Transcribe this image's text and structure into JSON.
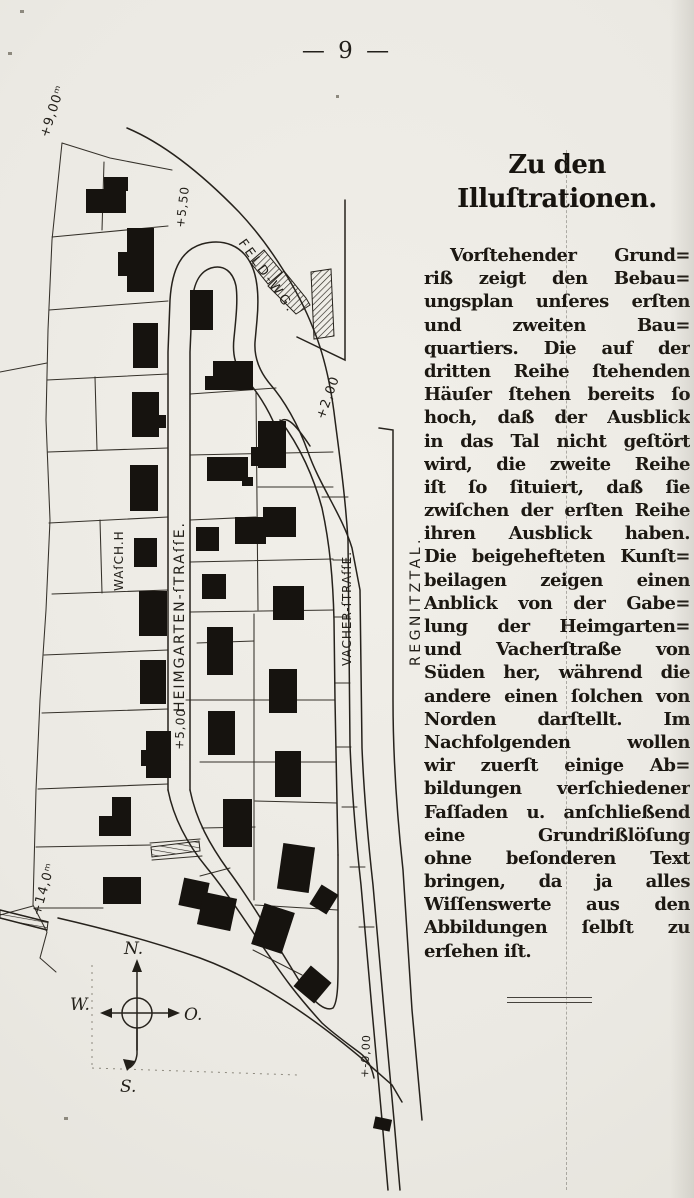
{
  "page": {
    "number_display": "— 9 —",
    "background": "#ebe9e3",
    "ink": "#1b1814"
  },
  "article": {
    "heading_lines": [
      "Zu den",
      "Illuſtrationen."
    ],
    "body_lines": [
      "Vorſtehender Grund=",
      "riß zeigt den Bebau=",
      "ungsplan unſeres erſten",
      "und zweiten Bau=",
      "quartiers. Die auf der",
      "dritten Reihe ſtehenden",
      "Häuſer ſtehen bereits ſo",
      "hoch, daß der Ausblick",
      "in das Tal nicht geſtört",
      "wird, die zweite Reihe",
      "iſt ſo ſituiert, daß ſie",
      "zwiſchen der erſten Reihe",
      "ihren Ausblick haben.",
      "Die beigehefteten Kunſt=",
      "beilagen zeigen einen",
      "Anblick von der Gabe=",
      "lung der Heimgarten=",
      "und Vacherſtraße von",
      "Süden her, während die",
      "andere einen ſolchen von",
      "Norden darſtellt. Im",
      "Nachfolgenden wollen",
      "wir zuerſt einige Ab=",
      "bildungen verſchiedener",
      "Faſſaden u. anſchließend",
      "eine Grundrißlöſung",
      "ohne beſonderen Text",
      "bringen, da ja alles",
      "Wiſſenswerte aus den",
      "Abbildungen ſelbſt zu",
      "erſehen iſt."
    ]
  },
  "map": {
    "ink": "#26221c",
    "streets": [
      "M 127,128 C 165,144 204,176 239,212 C 271,246 299,292 313,328 C 323,352 330,382 334,412 C 339,452 345,492 348,540 L 350,745 C 352,795 356,840 361,885 L 372,1010 L 382,1120 L 388,1190",
      "M 168,790 L 168,352 L 170,300 C 172,268 182,250 202,244 C 224,238 242,246 251,264 C 258,278 259,298 257,320 L 255,342 C 254,358 260,372 270,384 C 284,400 298,424 308,452 C 320,486 342,515 352,548 L 360,590 L 362,748 C 364,795 368,840 373,885 L 384,1010 L 394,1120 L 400,1190",
      "M 190,790 L 190,352 L 192,305 C 193,284 199,272 211,268 C 224,264 233,272 236,286 C 238,300 236,318 234,338 C 232,356 236,368 245,378 C 256,390 268,408 276,428 C 284,408 298,428 310,446",
      "M 190,790 C 196,820 210,845 228,870 C 252,902 280,950 305,990 C 315,1002 325,1012 333,1008 C 339,1000 338,975 338,940 L 338,855",
      "M 168,790 C 174,820 188,845 207,868 C 232,898 262,948 290,985 C 300,998 312,1012 322,1023 C 334,1034 348,1044 360,1053 C 368,1059 372,1068 374,1078",
      "M 58,918 C 110,930 160,944 200,958 C 230,969 258,984 283,1000 C 310,1017 340,1040 366,1062 L 392,1085 L 402,1102",
      "M 345,200 L 345,360 L 297,337",
      "M 379,428 L 393,430 L 393,700 C 393,760 397,815 403,870 L 412,1010 L 422,1120",
      "M 280,420 C 300,446 314,478 322,508 C 330,545 333,580 334,620 L 335,700 C 336,755 337,800 338,855",
      "M 0,910 L 48,922",
      "M 0,918 L 47,930"
    ],
    "parcels": [
      "M 62,143 L 52,240 L 48,330 L 46,420 L 50,520 L 46,610 L 40,700 L 36,790 L 33,905 L 47,932 L 40,958 L 56,972",
      "M 62,143 L 110,158 L 172,170",
      "M 0,372 L 47,363",
      "M 0,915 L 33,906",
      "M 52,237 L 168,226",
      "M 49,310 L 168,301",
      "M 47,380 L 168,374",
      "M 48,452 L 168,448",
      "M 49,523 L 168,517",
      "M 52,594 L 168,590",
      "M 44,655 L 168,650",
      "M 42,713 L 168,709",
      "M 38,789 L 168,784",
      "M 36,847 L 151,845",
      "M 34,908 L 103,908",
      "M 104,162 L 102,230",
      "M 95,377 L 97,450",
      "M 100,520 L 102,593",
      "M 190,394 L 276,388",
      "M 190,455 L 333,452",
      "M 258,487 L 333,487",
      "M 190,520 L 256,517",
      "M 190,562 L 333,559",
      "M 190,612 L 334,610",
      "M 197,643 L 254,641",
      "M 186,700 L 335,700",
      "M 200,762 L 336,762",
      "M 255,801 L 337,803",
      "M 202,828 L 255,827",
      "M 255,905 L 338,910",
      "M 253,950 L 302,975",
      "M 200,876 L 230,868",
      "M 256,392 L 258,610",
      "M 254,614 L 254,900",
      "M 322,497 L 348,497",
      "M 333,560 L 350,560",
      "M 334,617 L 350,617",
      "M 335,683 L 350,683",
      "M 336,747 L 351,747",
      "M 342,807 L 357,807",
      "M 350,867 L 365,867",
      "M 359,927 L 374,927",
      "M 150,843 L 200,839",
      "M 152,860 L 202,856"
    ],
    "buildings": [
      {
        "x": 86,
        "y": 189,
        "w": 40,
        "h": 24
      },
      {
        "x": 104,
        "y": 177,
        "w": 24,
        "h": 14
      },
      {
        "x": 127,
        "y": 228,
        "w": 27,
        "h": 64
      },
      {
        "x": 118,
        "y": 252,
        "w": 10,
        "h": 24
      },
      {
        "x": 133,
        "y": 323,
        "w": 25,
        "h": 45
      },
      {
        "x": 132,
        "y": 392,
        "w": 27,
        "h": 45
      },
      {
        "x": 159,
        "y": 415,
        "w": 7,
        "h": 13
      },
      {
        "x": 130,
        "y": 465,
        "w": 28,
        "h": 46
      },
      {
        "x": 134,
        "y": 538,
        "w": 23,
        "h": 29
      },
      {
        "x": 139,
        "y": 591,
        "w": 28,
        "h": 45
      },
      {
        "x": 140,
        "y": 660,
        "w": 26,
        "h": 44
      },
      {
        "x": 146,
        "y": 731,
        "w": 25,
        "h": 47
      },
      {
        "x": 141,
        "y": 750,
        "w": 6,
        "h": 16
      },
      {
        "x": 112,
        "y": 797,
        "w": 19,
        "h": 39
      },
      {
        "x": 99,
        "y": 816,
        "w": 14,
        "h": 20
      },
      {
        "x": 103,
        "y": 877,
        "w": 38,
        "h": 27
      },
      {
        "x": 181,
        "y": 880,
        "w": 26,
        "h": 28,
        "r": 12
      },
      {
        "x": 200,
        "y": 895,
        "w": 34,
        "h": 33,
        "r": 12
      },
      {
        "x": 190,
        "y": 290,
        "w": 23,
        "h": 40
      },
      {
        "x": 213,
        "y": 361,
        "w": 40,
        "h": 29
      },
      {
        "x": 205,
        "y": 376,
        "w": 9,
        "h": 14
      },
      {
        "x": 207,
        "y": 457,
        "w": 41,
        "h": 24
      },
      {
        "x": 242,
        "y": 477,
        "w": 11,
        "h": 9
      },
      {
        "x": 196,
        "y": 527,
        "w": 23,
        "h": 24
      },
      {
        "x": 202,
        "y": 574,
        "w": 24,
        "h": 25
      },
      {
        "x": 207,
        "y": 627,
        "w": 26,
        "h": 48
      },
      {
        "x": 208,
        "y": 711,
        "w": 27,
        "h": 44
      },
      {
        "x": 223,
        "y": 799,
        "w": 29,
        "h": 48
      },
      {
        "x": 258,
        "y": 421,
        "w": 28,
        "h": 47
      },
      {
        "x": 251,
        "y": 447,
        "w": 8,
        "h": 19
      },
      {
        "x": 235,
        "y": 517,
        "w": 31,
        "h": 27
      },
      {
        "x": 263,
        "y": 507,
        "w": 33,
        "h": 30
      },
      {
        "x": 273,
        "y": 586,
        "w": 31,
        "h": 34
      },
      {
        "x": 269,
        "y": 669,
        "w": 28,
        "h": 44
      },
      {
        "x": 275,
        "y": 751,
        "w": 26,
        "h": 46
      },
      {
        "x": 280,
        "y": 845,
        "w": 32,
        "h": 46,
        "r": 8
      },
      {
        "x": 314,
        "y": 888,
        "w": 20,
        "h": 23,
        "r": 32
      },
      {
        "x": 257,
        "y": 907,
        "w": 32,
        "h": 43,
        "r": 18
      },
      {
        "x": 299,
        "y": 971,
        "w": 27,
        "h": 27,
        "r": 40
      },
      {
        "x": 374,
        "y": 1118,
        "w": 17,
        "h": 12,
        "r": 12
      }
    ],
    "hatched": [
      {
        "points": "250,262 264,250 282,272 268,284",
        "fill": "hatch"
      },
      {
        "points": "268,286 284,271 306,298 310,305 296,314 278,296",
        "fill": "hatch"
      },
      {
        "points": "311,272 331,269 334,336 314,339",
        "fill": "hatch"
      },
      {
        "points": "151,847 199,841 200,851 152,857",
        "fill": "ties"
      },
      {
        "points": "0,910 48,922 47,930 0,918",
        "fill": "ties"
      }
    ],
    "dotted": [
      "M 92,965 L 92,1068",
      "M 92,1068 L 298,1075"
    ],
    "labels": [
      {
        "n": "elevation-plus-9-00",
        "t": "+9,00ᵐ",
        "x": 48,
        "y": 138,
        "r": -72,
        "s": 13,
        "ls": 1
      },
      {
        "n": "elevation-plus-5-50",
        "t": "+5,50",
        "x": 184,
        "y": 228,
        "r": -83,
        "s": 12,
        "ls": 1
      },
      {
        "n": "street-label-feld-weg",
        "t": "FELD-WG.",
        "x": 238,
        "y": 243,
        "r": 54,
        "s": 13,
        "ls": 3
      },
      {
        "n": "elevation-plus-2-00",
        "t": "+2,00",
        "x": 324,
        "y": 420,
        "r": -70,
        "s": 13,
        "ls": 1
      },
      {
        "n": "building-label-waschhaus",
        "t": "WAſCH.H",
        "x": 123,
        "y": 591,
        "r": -90,
        "s": 12,
        "ls": 1
      },
      {
        "n": "street-label-heimgartenstrasse",
        "t": "HEIMGARTEN-ſTRAſſE.",
        "x": 184,
        "y": 712,
        "r": -90,
        "s": 14,
        "ls": 2
      },
      {
        "n": "elevation-plus-5-00",
        "t": "+5,00",
        "x": 183,
        "y": 750,
        "r": -87,
        "s": 12,
        "ls": 1
      },
      {
        "n": "street-label-vacherstrasse",
        "t": "VACHER-ſTRAſſE.",
        "x": 351,
        "y": 666,
        "r": -90,
        "s": 12,
        "ls": 1
      },
      {
        "n": "area-label-regnitztal",
        "t": "REGNITZTAL.",
        "x": 420,
        "y": 666,
        "r": -90,
        "s": 14,
        "ls": 3.5
      },
      {
        "n": "elevation-zero",
        "t": "+-0,00",
        "x": 368,
        "y": 1078,
        "r": -87,
        "s": 11,
        "ls": 1
      },
      {
        "n": "elevation-plus-14-0",
        "t": "+14,0ᵐ",
        "x": 40,
        "y": 916,
        "r": -74,
        "s": 13,
        "ls": 1
      }
    ],
    "compass": {
      "circle": {
        "cx": 137,
        "cy": 1013,
        "r": 15
      },
      "shafts": [
        "M 137,1050 L 137,966",
        "M 103,1013 L 176,1013",
        "M 137,1028 L 137,1054 Q 136,1064 129,1068"
      ],
      "heads": [
        "137,959 132,972 142,972",
        "100,1013 112,1008 112,1018",
        "180,1013 168,1008 168,1018",
        "127,1071 123,1059 135,1061"
      ],
      "labels": [
        {
          "t": "N.",
          "x": 124,
          "y": 954
        },
        {
          "t": "O.",
          "x": 184,
          "y": 1020
        },
        {
          "t": "W.",
          "x": 70,
          "y": 1010
        },
        {
          "t": "S.",
          "x": 120,
          "y": 1092
        }
      ]
    },
    "specks": [
      [
        8,
        52,
        4,
        3
      ],
      [
        64,
        1117,
        4,
        3
      ],
      [
        336,
        95,
        3,
        3
      ],
      [
        20,
        10,
        4,
        3
      ]
    ]
  }
}
